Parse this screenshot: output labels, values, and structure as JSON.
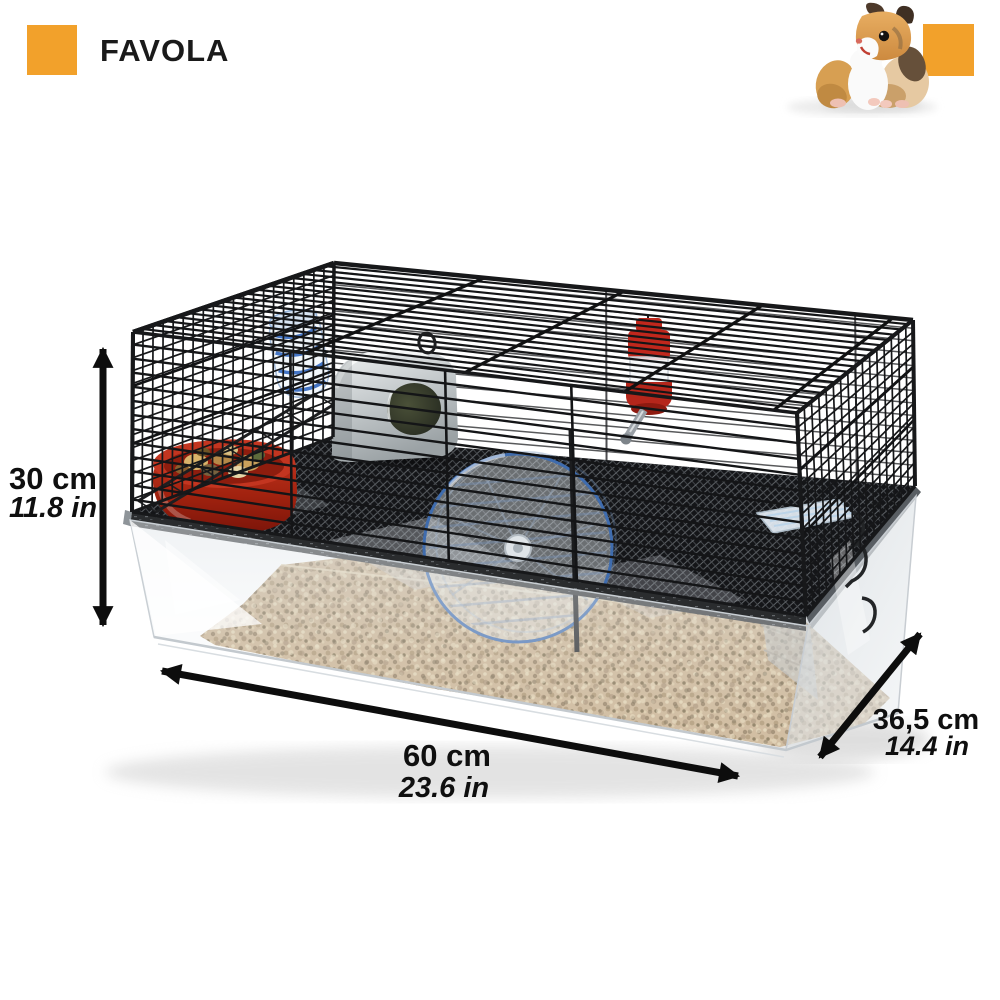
{
  "brand": {
    "title": "FAVOLA",
    "logo_color": "#F2A12B"
  },
  "decor": {
    "corner_square_color": "#F2A12B"
  },
  "dimensions": {
    "height_cm": "30 cm",
    "height_in": "11.8 in",
    "length_cm": "60 cm",
    "length_in": "23.6 in",
    "depth_cm": "36,5 cm",
    "depth_in": "14.4 in"
  },
  "scene": {
    "subject": "hamster-cage-product-photo",
    "colors": {
      "wire": "#17181A",
      "bedding": "#C6AD8A",
      "bowl_red": "#B8301F",
      "wheel_rim_blue": "#3F6CAE",
      "bottle_red": "#C0271C",
      "tube_stripe_blue": "#3A6EC2",
      "house_grey": "#C6CBCD",
      "arrow": "#0D0D0D",
      "text": "#0F0F0F"
    }
  }
}
